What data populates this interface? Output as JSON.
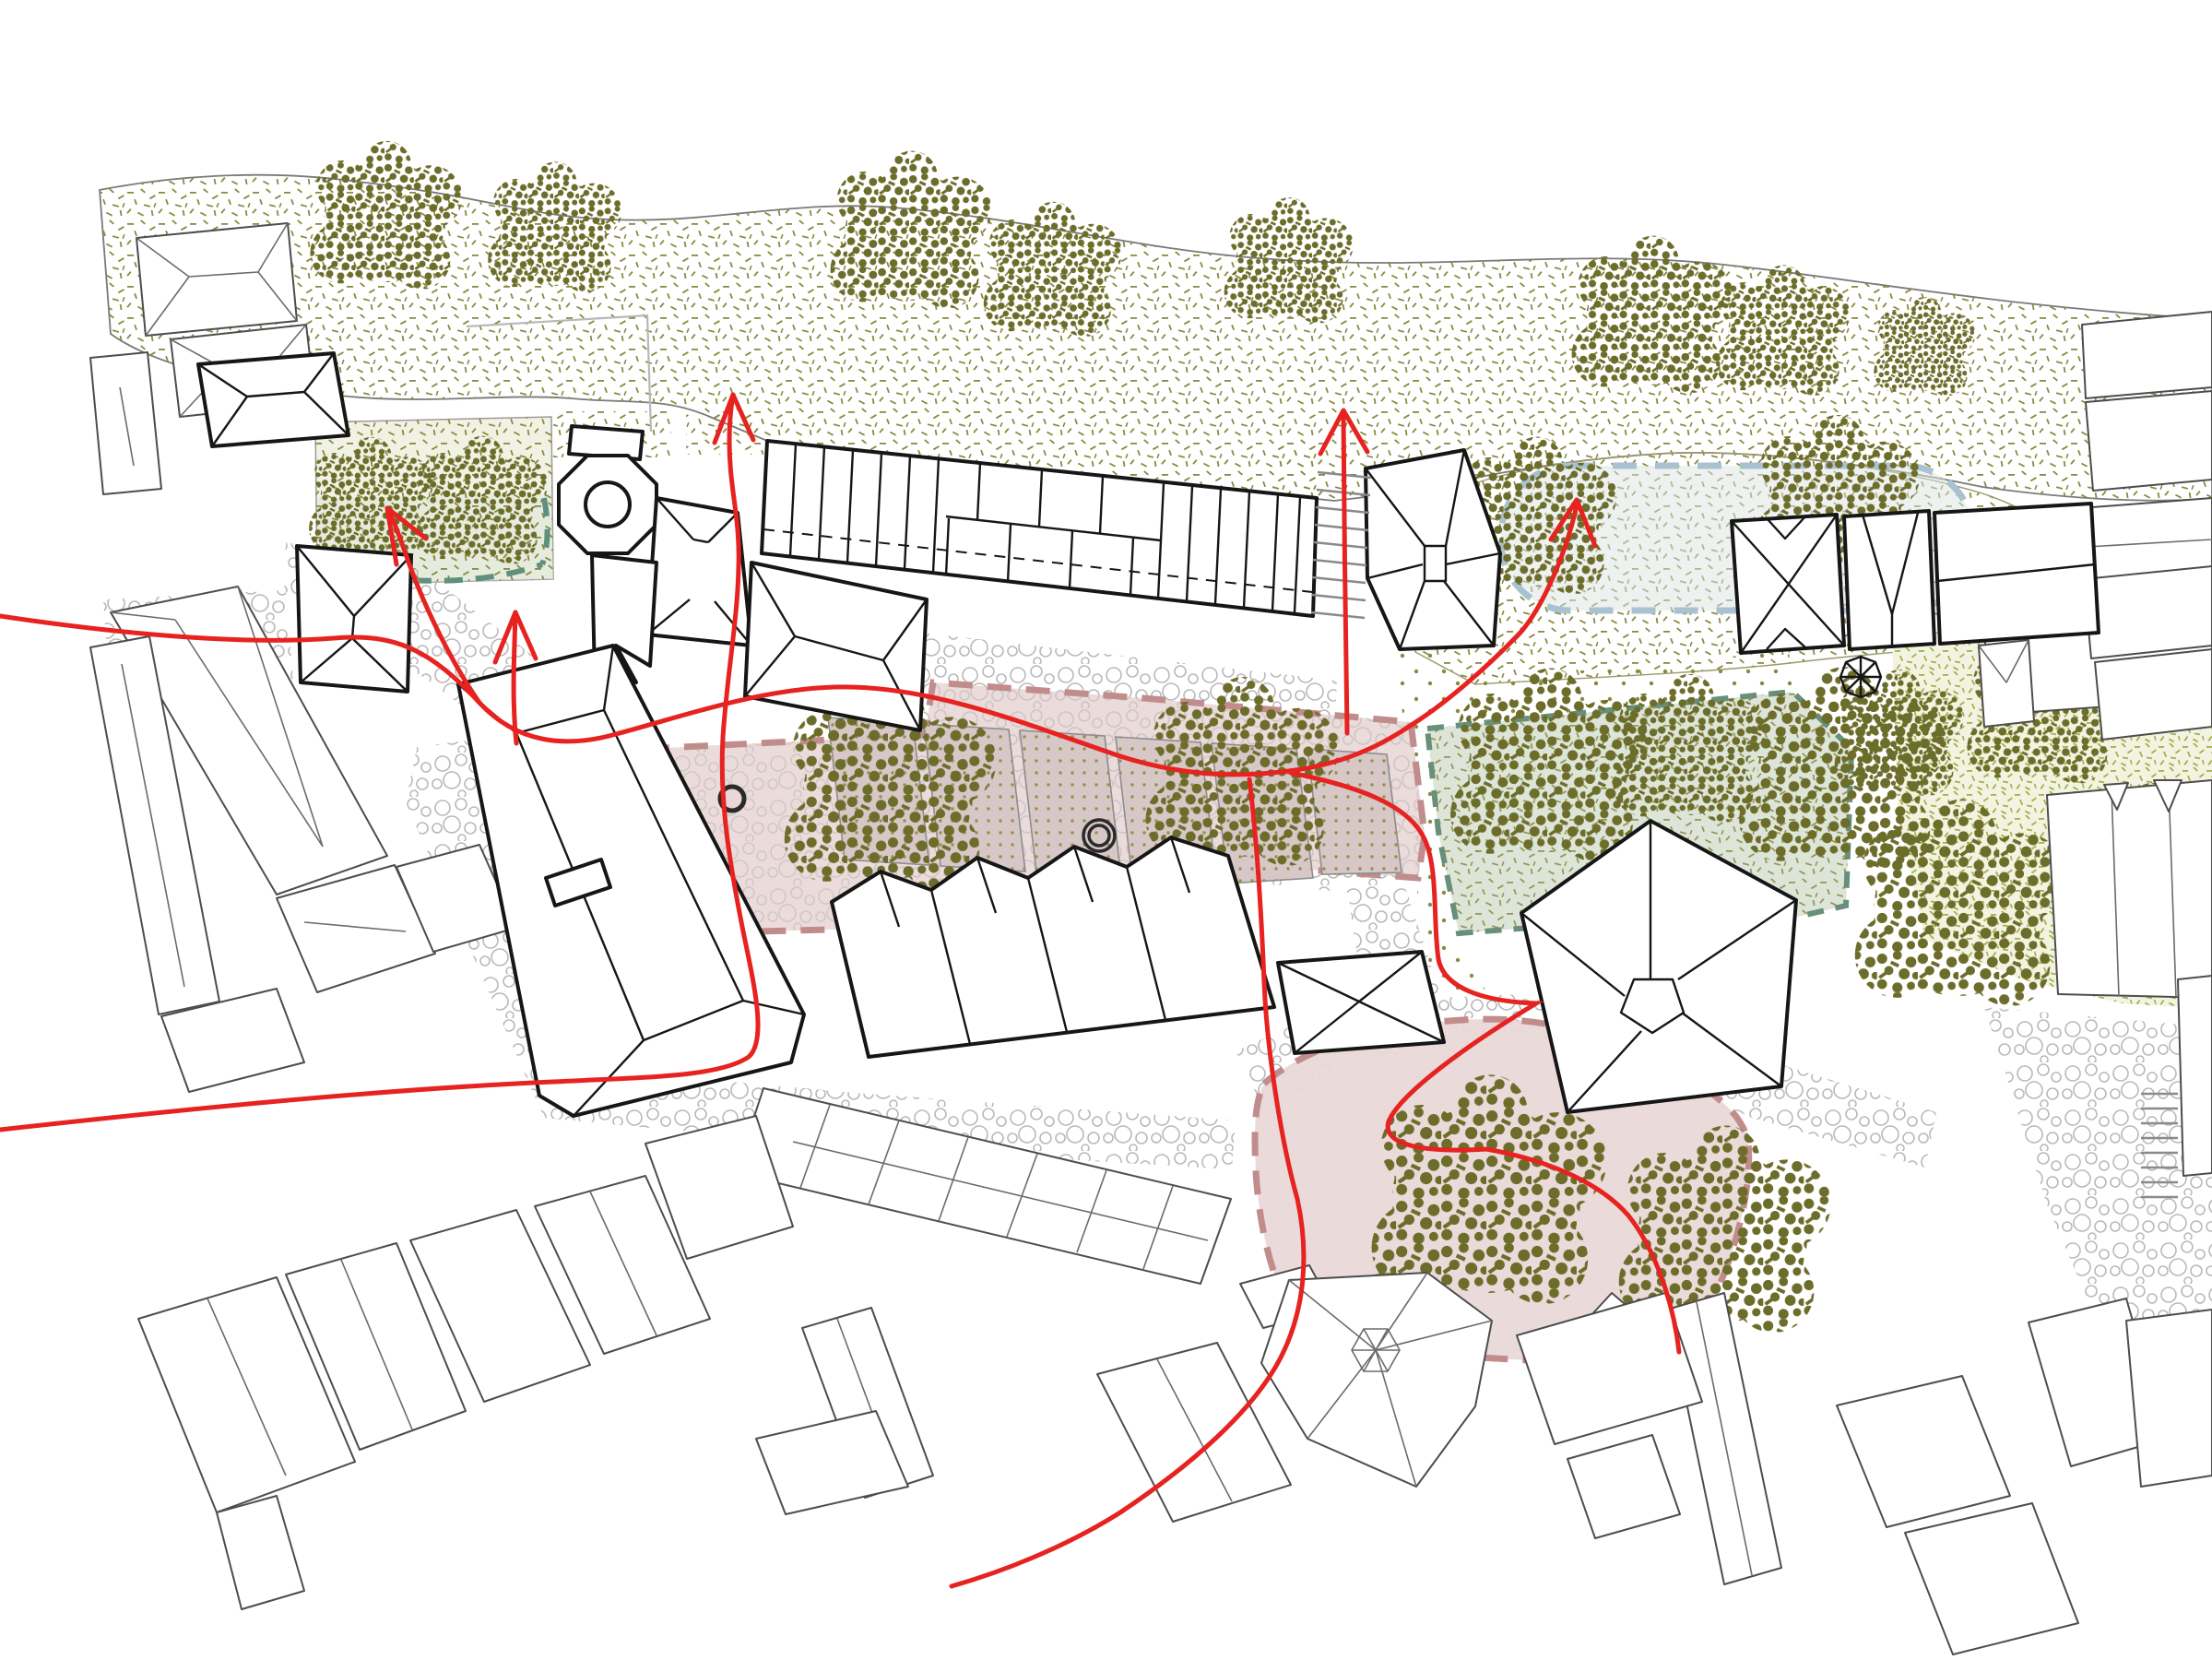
{
  "page": {
    "title": "Urban design site plan — roofscape figure-ground with landscape zones and pedestrian circulation",
    "drawing_type": "architectural site plan (no text labels present in drawing)",
    "orientation_note": "hillside vegetation band across the top, historic centre below"
  },
  "colors": {
    "background": "#ffffff",
    "circulation_red": "#e62320",
    "site_building_stroke": "#161616",
    "context_building_stroke": "#4d4d4d",
    "faint_outline": "#b8b8b8",
    "olive_stipple": "#8a8a3f",
    "tree_foliage": "#6d6d2b",
    "yellow_green_stipple": "#a5af4e",
    "pink_zone_fill": "#e9d8d7",
    "pink_zone_border": "#c18d8c",
    "green_zone_fill": "#dde5d8",
    "green_zone_border": "#678f7a",
    "teal_dash": "#5f8f7d",
    "blue_dash": "#a9c2d0",
    "cobble_stroke": "#b9b9b9",
    "bed_dot": "#93934a",
    "mound_fill": "#e6dcb2",
    "mound_stipple": "#93833c",
    "band_edge": "#7a7a7a"
  },
  "zones": [
    {
      "id": "hillside-band",
      "kind": "existing vegetation slope",
      "texture": "olive stipple",
      "trees": 8
    },
    {
      "id": "upper-meadow-east",
      "kind": "meadow with blue dashed boundary",
      "trees": 2
    },
    {
      "id": "pocket-garden-west",
      "kind": "small garden with teal dashed edge",
      "trees": 2
    },
    {
      "id": "courtyard-garden",
      "kind": "proposed public garden (pink dashed)",
      "planting_beds": 5,
      "trees": 2,
      "tree_rings": 2
    },
    {
      "id": "gathering-space-south",
      "kind": "proposed public space (pink dashed)",
      "trees": 2,
      "mounds": 1
    },
    {
      "id": "grove-east",
      "kind": "tree grove with green dashed boundary",
      "trees": 3
    },
    {
      "id": "garden-east",
      "kind": "dense garden, yellow-green stipple",
      "trees": 4
    }
  ],
  "circulation": {
    "style": "freehand red lines with open V arrowheads",
    "route_count": 7,
    "arrows": [
      {
        "id": "arrow-north-centre",
        "direction": "north",
        "location": "gap west of terraced row up to the slope"
      },
      {
        "id": "arrow-north-stairs",
        "direction": "north",
        "location": "stair run east of terraced row"
      },
      {
        "id": "arrow-northeast-meadow",
        "direction": "north-east",
        "location": "into upper meadow"
      },
      {
        "id": "arrow-northwest-garden",
        "direction": "north-west",
        "location": "into pocket garden"
      },
      {
        "id": "arrow-north-square",
        "direction": "north",
        "location": "central square by the church"
      }
    ]
  },
  "site_buildings": [
    "church with octagonal spire tower",
    "terraced long range (north) with party-wall divisions and dashed eave line",
    "west range with ridge rectangle and chimney",
    "south-east gabled row",
    "pentagonal-roof hall",
    "east court range with x-hip roofs and small octagonal turret",
    "north-east trapezoid hall with x-hip roof",
    "street-corner hipped house pair"
  ],
  "context_features": [
    "surrounding hipped-roof houses drawn as thin grey roof plans",
    "grey chapel with hexagonal spire star (south)",
    "two stair runs drawn as ladder hatch",
    "cobbled street surfaces drawn as circle texture"
  ],
  "counts": {
    "trees_total": 24,
    "planting_beds": 6,
    "tree_rings": 2,
    "stair_runs": 2
  }
}
